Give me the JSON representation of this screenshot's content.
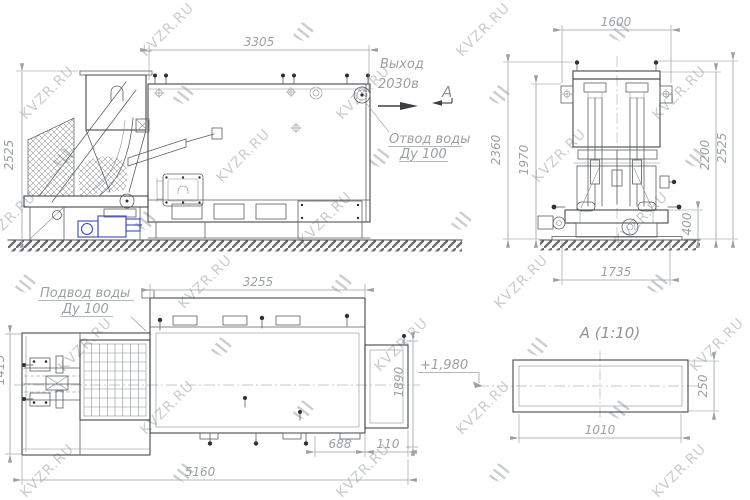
{
  "watermark": {
    "text": "KVZR.RU"
  },
  "colors": {
    "line": "#44484c",
    "dimension": "#9ba0a4",
    "accent_blue": "#3a46c4",
    "watermark": "#b7bcc0"
  },
  "views": {
    "side": {
      "dim_width": "3305",
      "dim_height": "2525",
      "outlet_label": "Выход",
      "outlet_value": "2030в",
      "section_letter": "А",
      "drain_label_1": "Отвод воды",
      "drain_label_2": "Ду 100"
    },
    "front": {
      "dim_width_top": "1600",
      "dim_height_outer": "2360",
      "dim_height_inner": "1970",
      "dim_right_1": "400",
      "dim_right_2": "2200",
      "dim_right_3": "2525",
      "dim_width_bottom": "1735"
    },
    "plan": {
      "supply_label_1": "Подвод воды",
      "supply_label_2": "Ду 100",
      "dim_top": "3255",
      "dim_left": "1415",
      "dim_right": "1890",
      "dim_bottom_1": "688",
      "dim_bottom_2": "110",
      "dim_bottom_total": "5160"
    },
    "detail": {
      "title": "А  (1:10)",
      "level_mark": "+1,980",
      "dim_width": "1010",
      "dim_height": "250"
    }
  }
}
